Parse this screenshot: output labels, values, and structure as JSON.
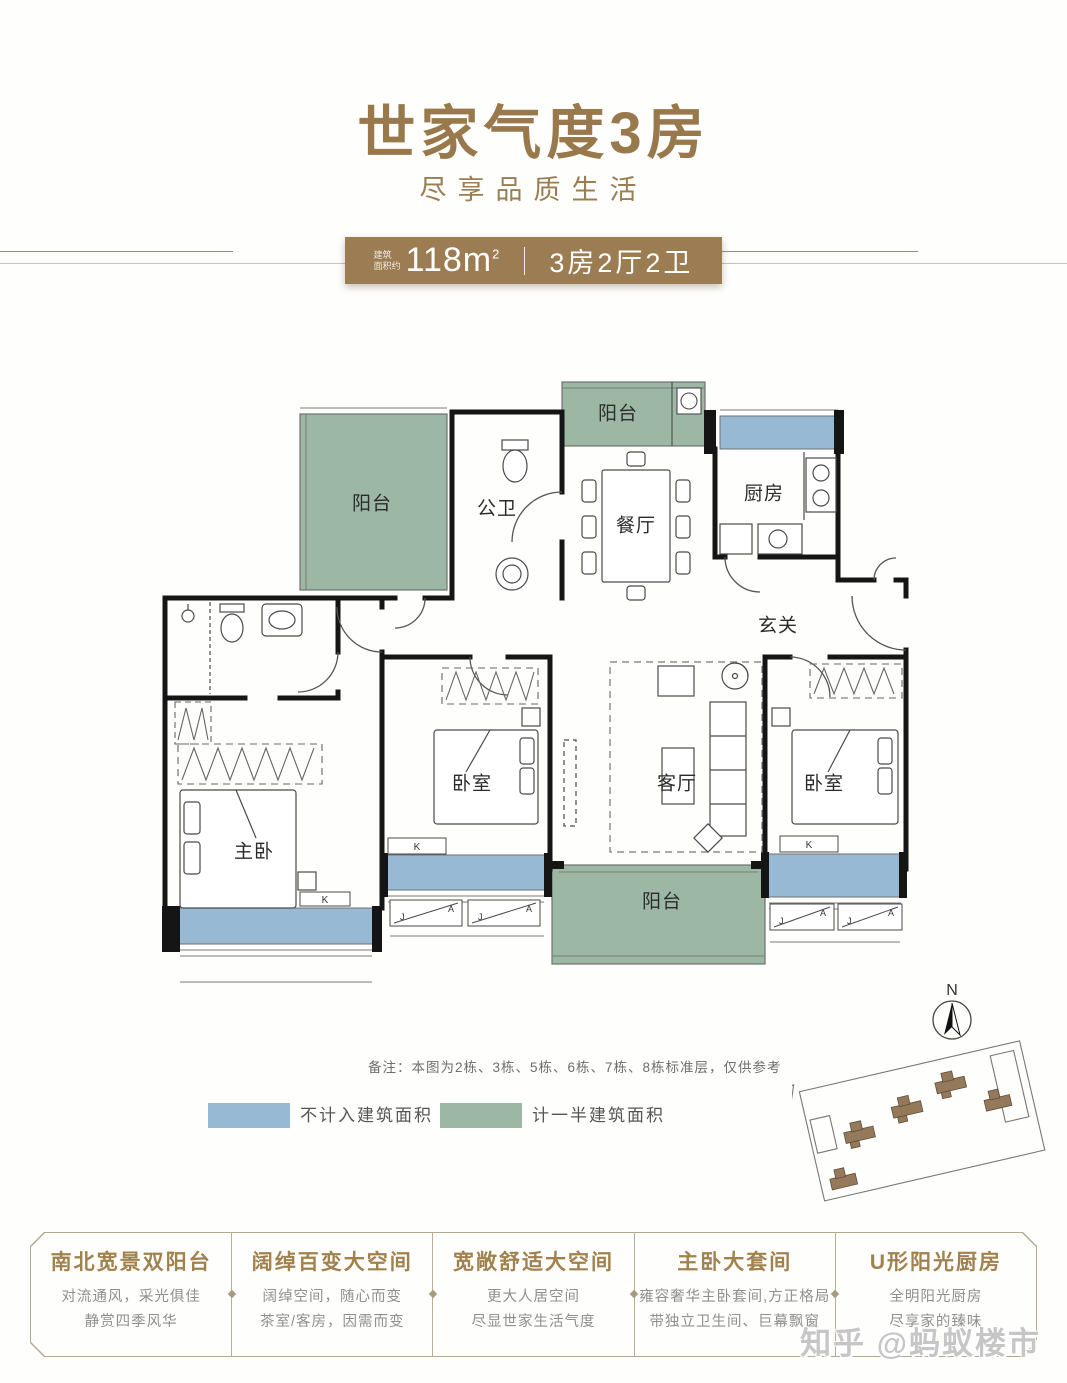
{
  "header": {
    "title": "世家气度3房",
    "subtitle": "尽享品质生活",
    "banner": {
      "area_label_line1": "建筑",
      "area_label_line2": "面积约",
      "area_value": "118m",
      "area_exponent": "2",
      "unit_spec": "3房2厅2卫"
    }
  },
  "floorplan": {
    "rooms": [
      {
        "id": "balcony-top-left",
        "label": "阳台"
      },
      {
        "id": "guest-bathroom",
        "label": "公卫"
      },
      {
        "id": "balcony-top-middle",
        "label": "阳台"
      },
      {
        "id": "dining-room",
        "label": "餐厅"
      },
      {
        "id": "kitchen",
        "label": "厨房"
      },
      {
        "id": "foyer",
        "label": "玄关"
      },
      {
        "id": "master-bedroom",
        "label": "主卧"
      },
      {
        "id": "bedroom-middle",
        "label": "卧室"
      },
      {
        "id": "living-room",
        "label": "客厅"
      },
      {
        "id": "bedroom-right",
        "label": "卧室"
      },
      {
        "id": "balcony-bottom",
        "label": "阳台"
      }
    ],
    "marks": {
      "window_k": "K",
      "window_j": "J",
      "window_a": "A",
      "compass_north": "N"
    },
    "note": "备注：本图为2栋、3栋、5栋、6栋、7栋、8栋标准层，仅供参考",
    "legend": [
      {
        "label": "不计入建筑面积",
        "color": "#97b9d4"
      },
      {
        "label": "计一半建筑面积",
        "color": "#9cb8a4"
      }
    ]
  },
  "features": [
    {
      "title": "南北宽景双阳台",
      "line1": "对流通风，采光俱佳",
      "line2": "静赏四季风华"
    },
    {
      "title": "阔绰百变大空间",
      "line1": "阔绰空间，随心而变",
      "line2": "茶室/客房，因需而变"
    },
    {
      "title": "宽敞舒适大空间",
      "line1": "更大人居空间",
      "line2": "尽显世家生活气度"
    },
    {
      "title": "主卧大套间",
      "line1": "雍容奢华主卧套间,方正格局",
      "line2": "带独立卫生间、巨幕飘窗"
    },
    {
      "title": "U形阳光厨房",
      "line1": "全明阳光厨房",
      "line2": "尽享家的臻味"
    }
  ],
  "watermark": "知乎 @蚂蚁楼市",
  "colors": {
    "accent_gold": "#9c7c52",
    "balcony_green": "#9cb8a4",
    "baywindow_blue": "#97b9d4",
    "wall_black": "#151515"
  }
}
